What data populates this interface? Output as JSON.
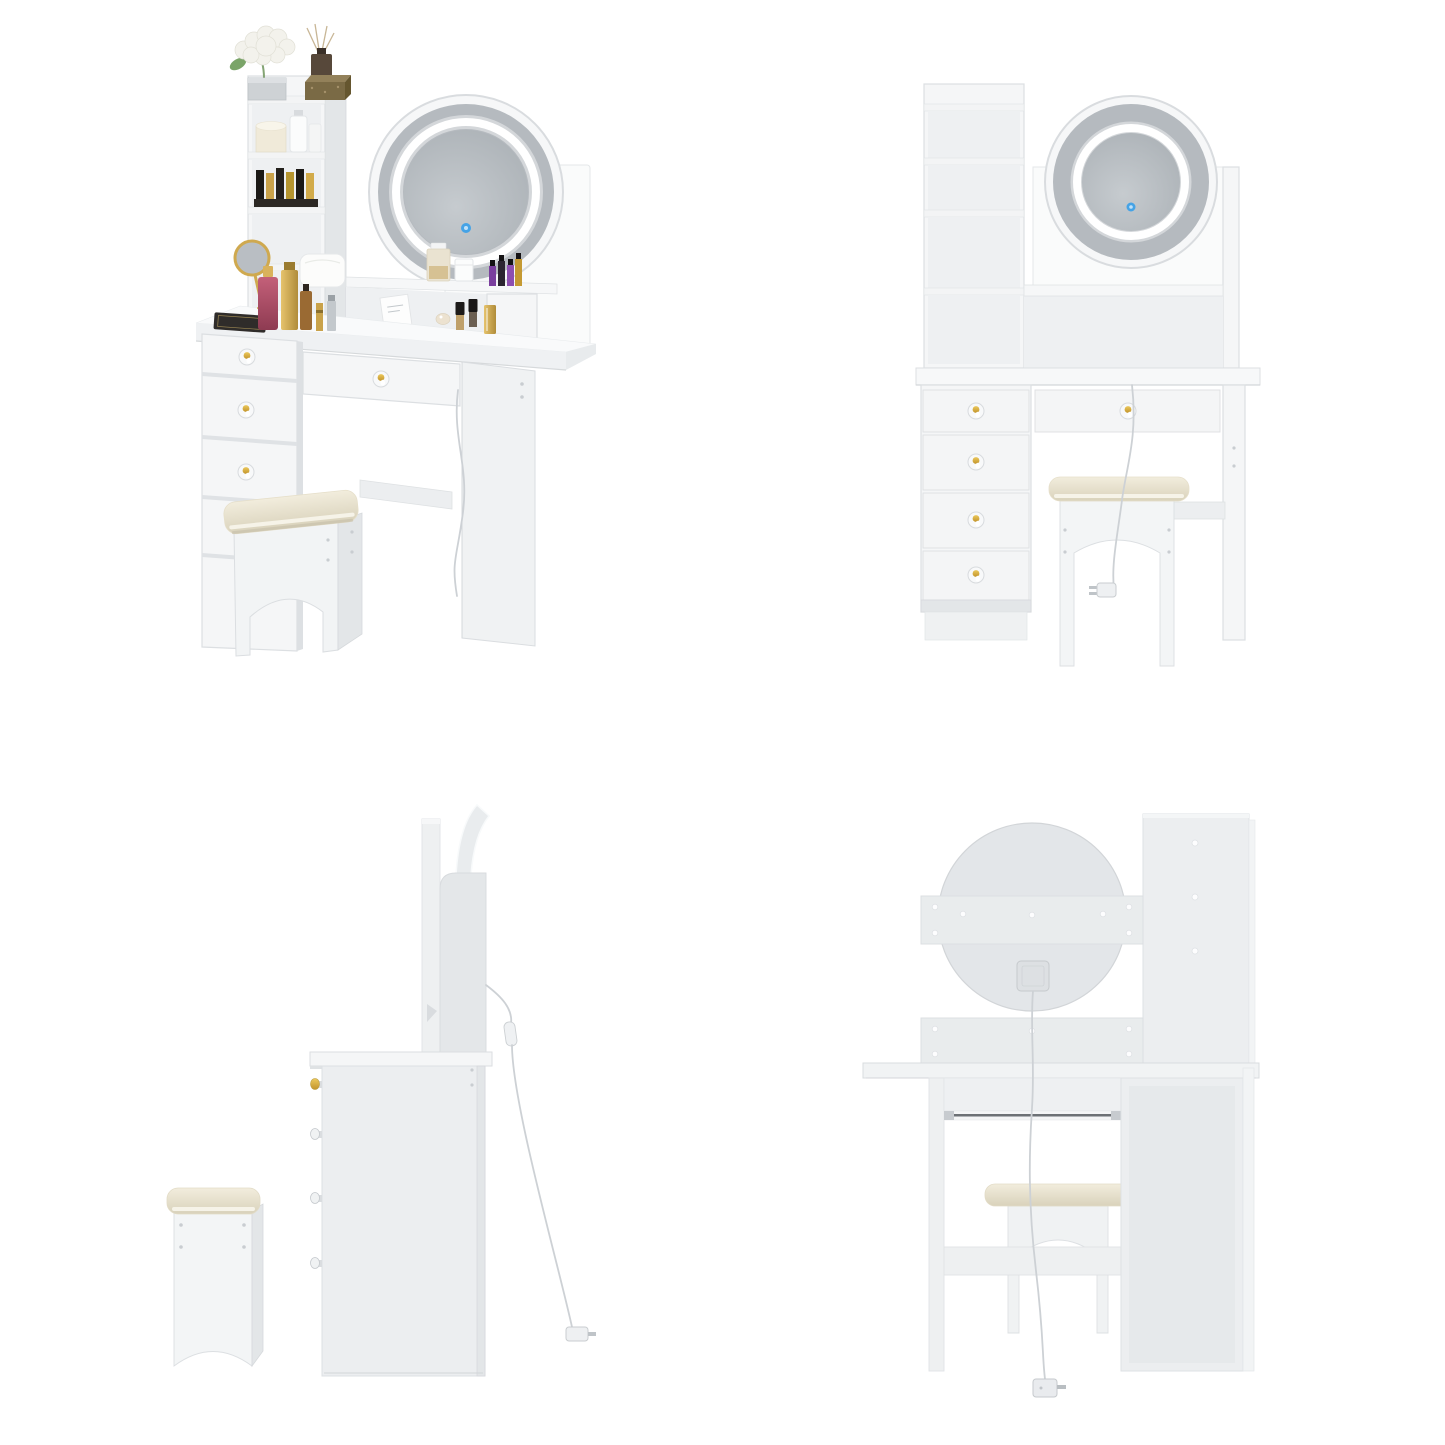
{
  "page": {
    "background": "#ffffff",
    "layout": "2x2-product-image-grid",
    "image_size": "1445x1445"
  },
  "views": [
    {
      "id": "angled",
      "label": "styled angled view",
      "position": "top-left"
    },
    {
      "id": "front",
      "label": "front view",
      "position": "top-right"
    },
    {
      "id": "side",
      "label": "side view",
      "position": "bottom-left"
    },
    {
      "id": "back",
      "label": "back view",
      "position": "bottom-right"
    }
  ],
  "product": {
    "kind": "vanity desk set with round LED mirror and stool",
    "drawers_left_bank": 4,
    "drawers_wide": 1,
    "tower_shelves": 4,
    "mirror": {
      "shape": "round",
      "led_ring": true,
      "touch_control": true
    },
    "stool": {
      "cushion": "cream",
      "arch_cutout": true
    },
    "power": {
      "cable": true,
      "wall_plug": true,
      "junction_box_on_mirror_back": true
    }
  },
  "colors": {
    "background": "#ffffff",
    "panel_white": "#f5f6f7",
    "panel_shade": "#e3e6e8",
    "panel_interior": "#eef0f2",
    "outline_gray": "#dcdfe2",
    "mirror_bezel": "#b5babf",
    "glass_light": "#c6cbcf",
    "glass_dark": "#a9afb4",
    "led_ring": "#ffffff",
    "touch_button": "#45a3e6",
    "knob_gold_light": "#ecc95c",
    "knob_gold_dark": "#c2942c",
    "cushion_light": "#f2eddd",
    "cushion_dark": "#d9d2bb",
    "cable_gray": "#cdd1d5",
    "gold_accent": "#c9a24a",
    "purple_polish": "#7a3f9e",
    "pink_perfume_light": "#c46079",
    "pink_perfume_dark": "#8e3b52",
    "slide_rail": "#6d7175"
  }
}
